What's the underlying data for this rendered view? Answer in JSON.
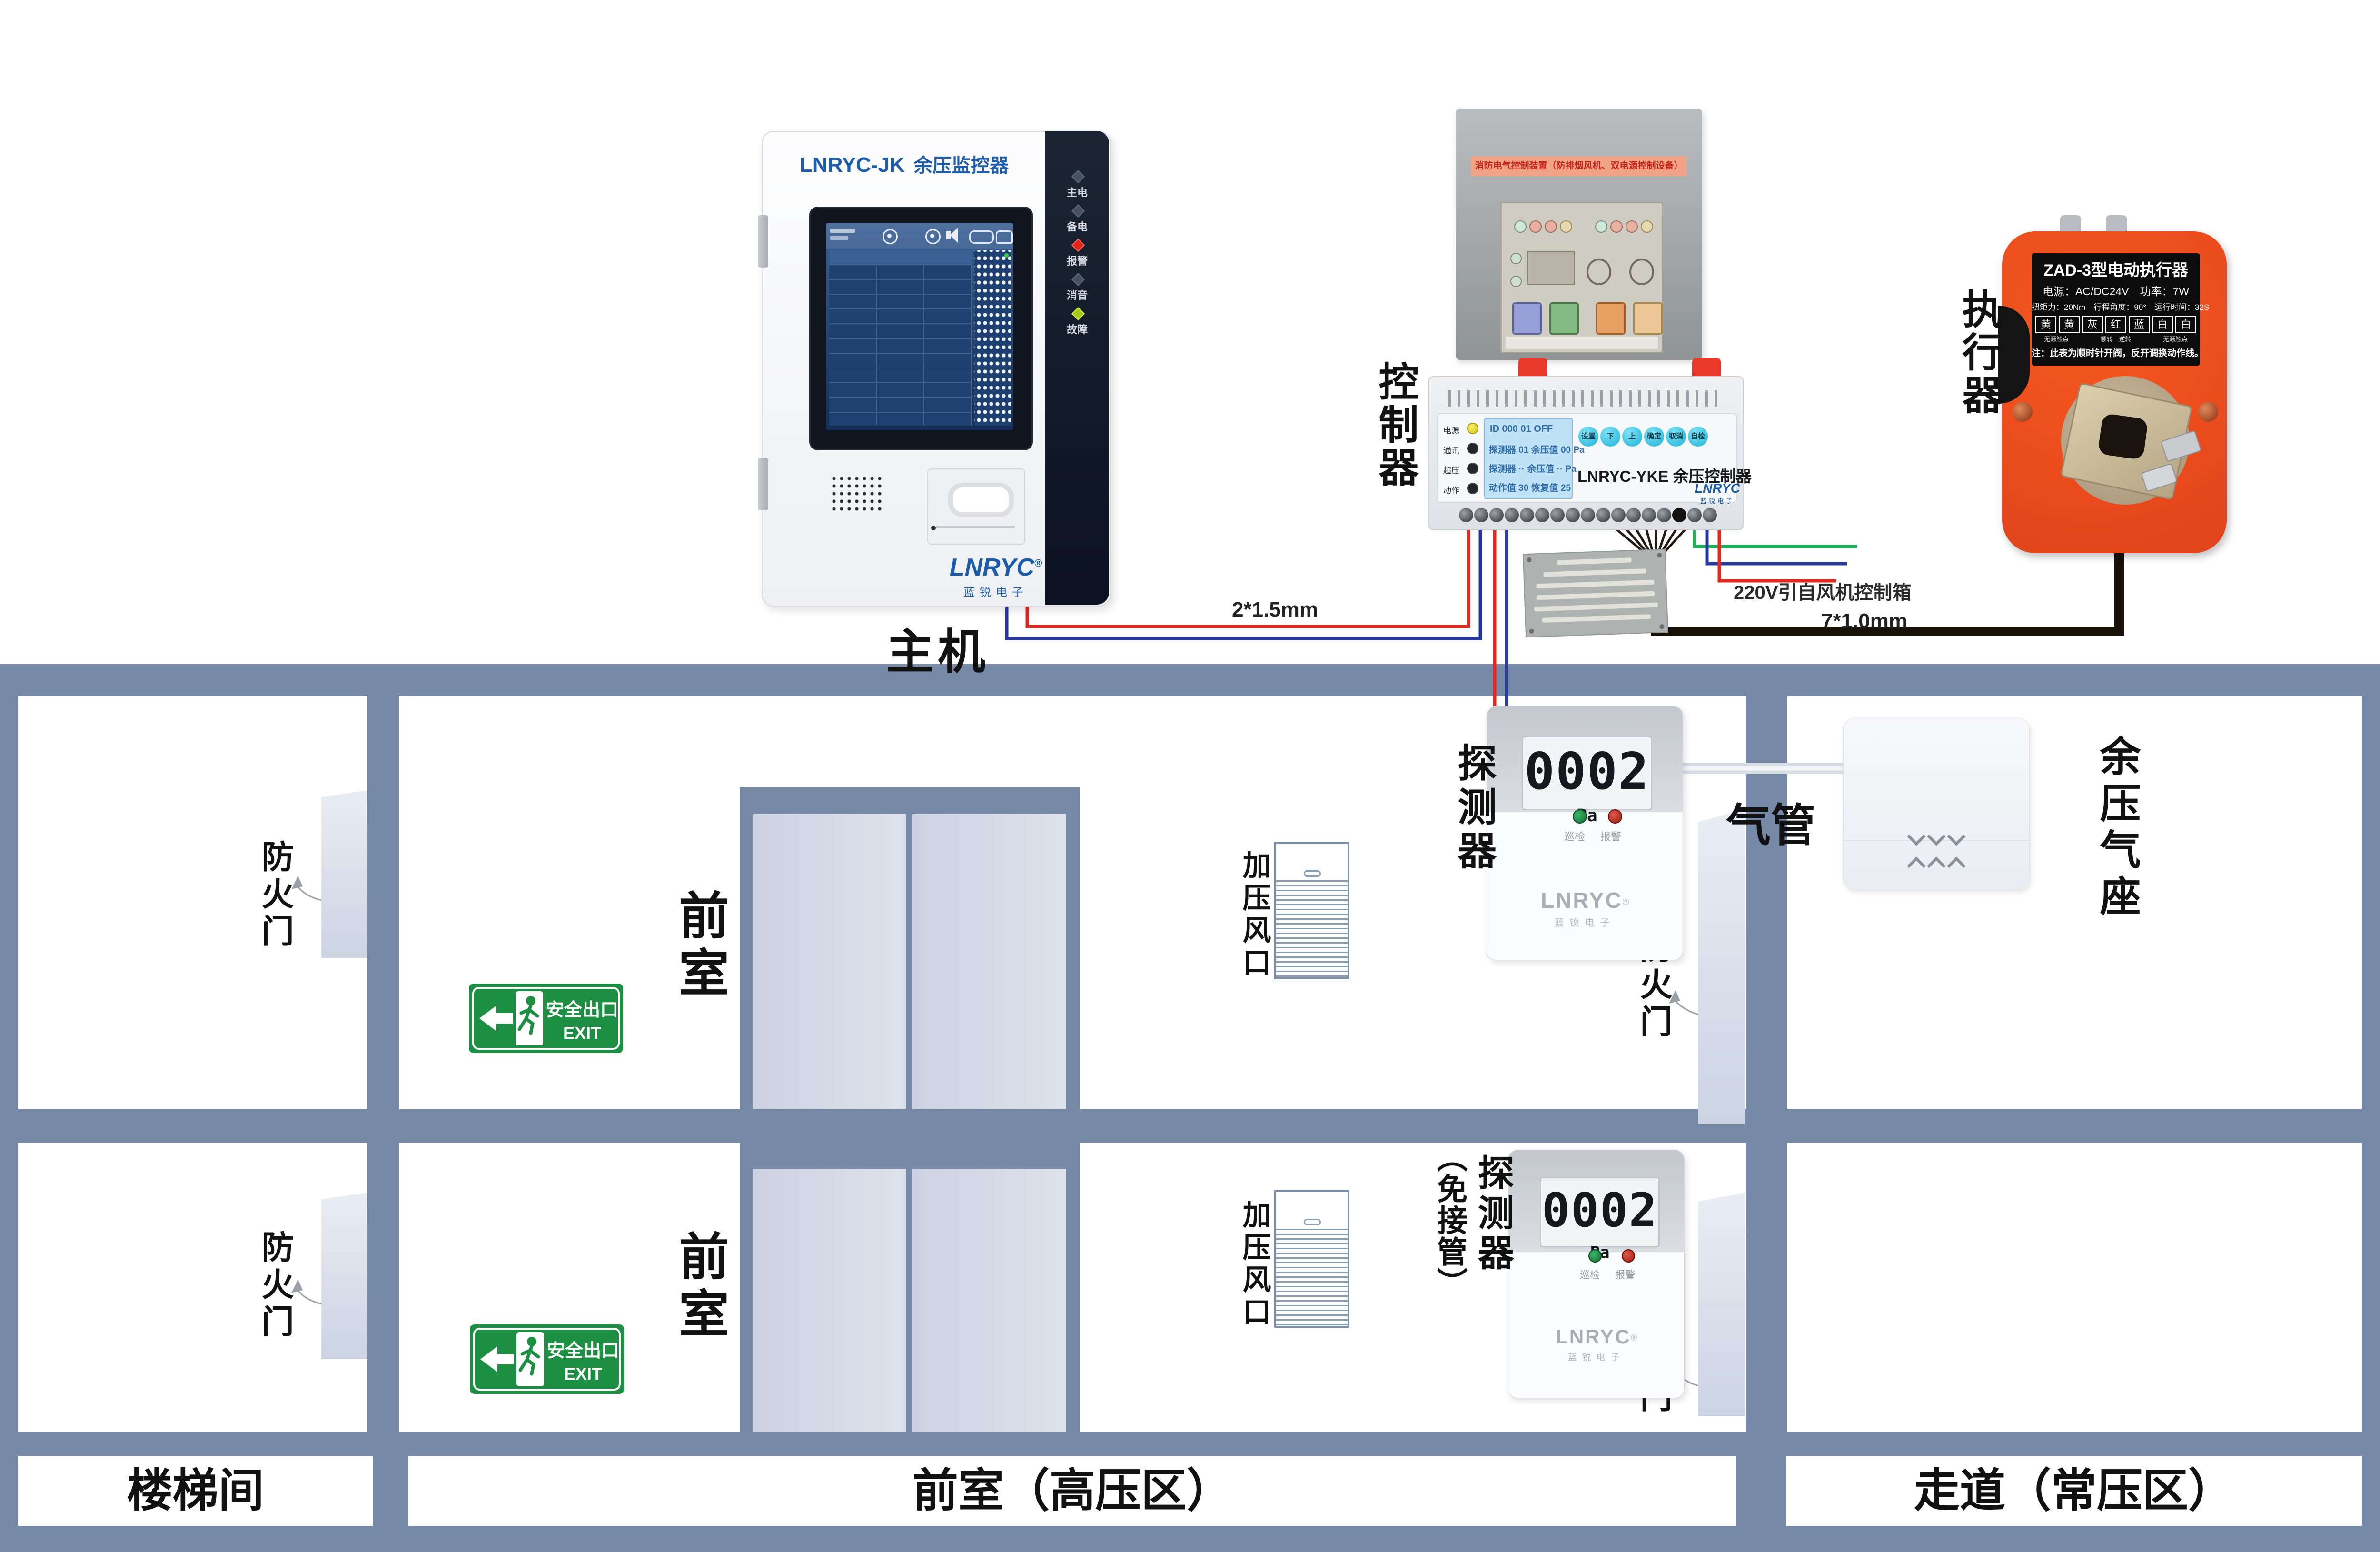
{
  "host": {
    "title_model": "LNRYC-JK",
    "title_product": "余压监控器",
    "leds": [
      {
        "label": "主电"
      },
      {
        "label": "备电"
      },
      {
        "label": "报警"
      },
      {
        "label": "消音"
      },
      {
        "label": "故障"
      }
    ],
    "logo": "LNRYC",
    "logo_reg": "®",
    "logo_sub": "蓝锐电子",
    "label": "主机"
  },
  "controller": {
    "label": "控制器",
    "firebox_banner": "消防电气控制装置（防排烟风机、双电源控制设备）",
    "din": {
      "leds": [
        {
          "label": "电源"
        },
        {
          "label": "通讯"
        },
        {
          "label": "超压"
        },
        {
          "label": "动作"
        }
      ],
      "lcd_lines": [
        "ID 000   01   OFF",
        "探测器 01 余压值 00 Pa",
        "探测器 ·· 余压值 ·· Pa",
        "动作值 30  恢复值 25"
      ],
      "buttons": [
        "设置",
        "下",
        "上",
        "确定",
        "取消",
        "自检"
      ],
      "model": "LNRYC-YKE 余压控制器",
      "logo": "LNRYC",
      "logo_sub": "蓝锐电子"
    },
    "wire_label_bus": "2*1.5mm",
    "wire_label_actuator": "7*1.0mm",
    "wire_label_power": "220V引自风机控制箱"
  },
  "actuator": {
    "label": "执行器",
    "plate": {
      "title": "ZAD-3型电动执行器",
      "line2": "电源：AC/DC24V　功率：7W",
      "line3": "扭矩力：20Nm　行程角度：90°　运行时间：32S",
      "wire_cells": [
        "黄",
        "黄",
        "灰",
        "红",
        "蓝",
        "白",
        "白"
      ],
      "note_left": "无源触点",
      "note_mid": "顺转　逆转",
      "note_right": "无源触点",
      "note": "注：此表为顺时针开阀，反开调换动作线。"
    }
  },
  "plan": {
    "zone_left": "楼梯间",
    "zone_center": "前室（高压区）",
    "zone_right": "走道（常压区）",
    "fire_door": "防火门",
    "front_room": "前室",
    "vent": "加压风口",
    "tube": "气管",
    "seat": "余压气座",
    "exit": {
      "cn": "安全出口",
      "en": "EXIT"
    },
    "detector1": {
      "label": "探测器"
    },
    "detector2": {
      "label": "探测器",
      "label_sub": "（免接管）"
    },
    "detector": {
      "value": "0002",
      "unit": "Pa",
      "led_green": "巡检",
      "led_red": "报警",
      "logo": "LNRYC",
      "logo_sub": "蓝锐电子"
    }
  },
  "colors": {
    "wall": "#7689a6",
    "accent_blue": "#1d5cab",
    "exit_green": "#1d8f42",
    "actuator_orange": "#f05123",
    "wire_red": "#e02a20",
    "wire_blue": "#2a3a9c",
    "wire_green": "#19b257"
  }
}
